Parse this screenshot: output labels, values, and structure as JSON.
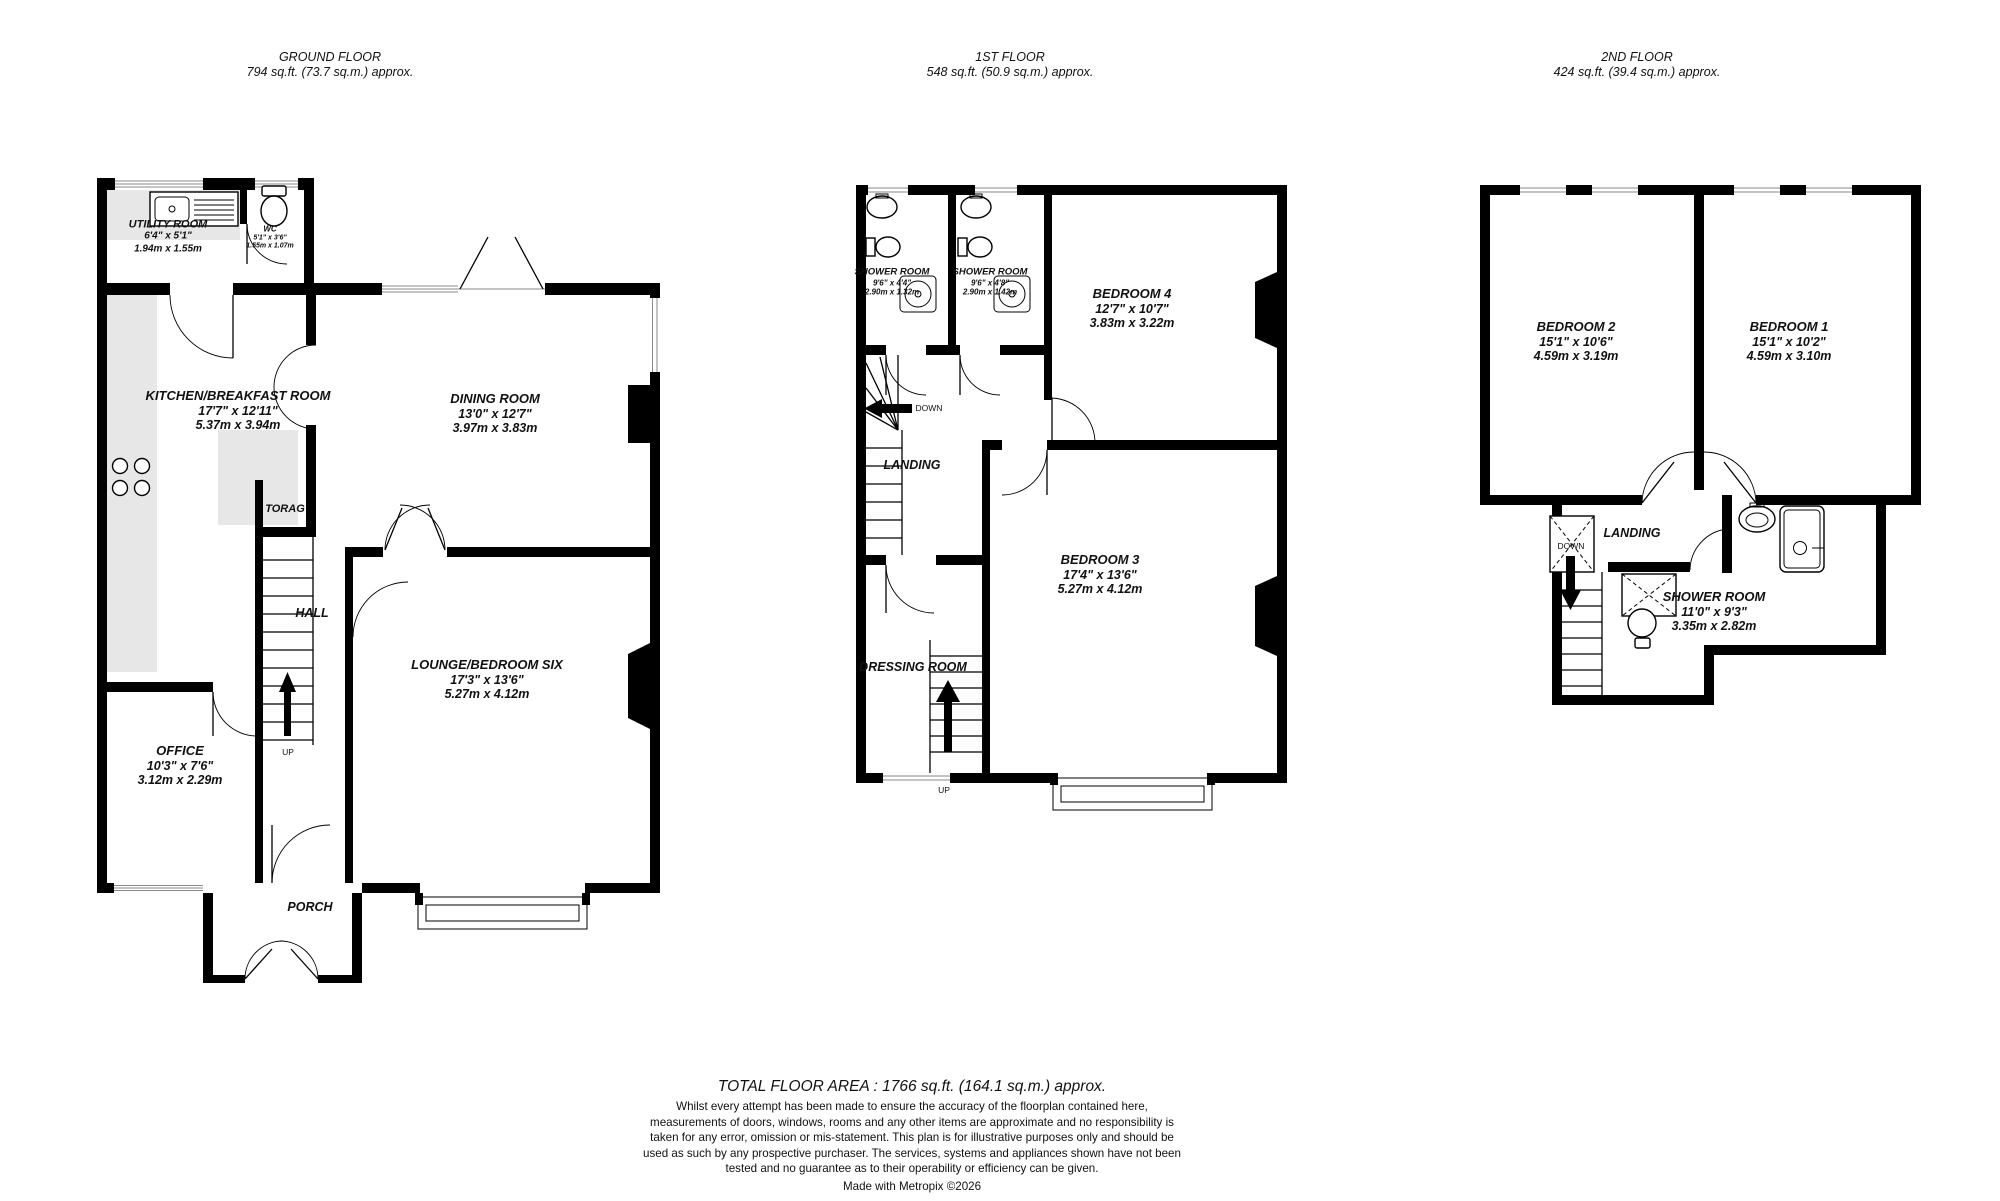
{
  "floors": {
    "ground": {
      "title": "GROUND FLOOR",
      "area": "794 sq.ft. (73.7 sq.m.) approx.",
      "rooms": {
        "utility": {
          "name": "UTILITY ROOM",
          "ft": "6'4\" x 5'1\"",
          "m": "1.94m x 1.55m"
        },
        "wc": {
          "name": "WC",
          "ft": "5'1\" x 3'6\"",
          "m": "1.55m x 1.07m"
        },
        "kitchen": {
          "name": "KITCHEN/BREAKFAST ROOM",
          "ft": "17'7\" x 12'11\"",
          "m": "5.37m x 3.94m"
        },
        "dining": {
          "name": "DINING ROOM",
          "ft": "13'0\" x 12'7\"",
          "m": "3.97m x 3.83m"
        },
        "storage": {
          "name": "TORAG"
        },
        "hall": {
          "name": "HALL"
        },
        "office": {
          "name": "OFFICE",
          "ft": "10'3\" x 7'6\"",
          "m": "3.12m x 2.29m"
        },
        "lounge": {
          "name": "LOUNGE/BEDROOM SIX",
          "ft": "17'3\" x 13'6\"",
          "m": "5.27m x 4.12m"
        },
        "porch": {
          "name": "PORCH"
        }
      },
      "stairs_up_label": "UP"
    },
    "first": {
      "title": "1ST FLOOR",
      "area": "548 sq.ft. (50.9 sq.m.) approx.",
      "rooms": {
        "shower1": {
          "name": "SHOWER ROOM",
          "ft": "9'6\" x 4'4\"",
          "m": "2.90m x 1.32m"
        },
        "shower2": {
          "name": "SHOWER ROOM",
          "ft": "9'6\" x 4'8\"",
          "m": "2.90m x 1.42m"
        },
        "bedroom4": {
          "name": "BEDROOM 4",
          "ft": "12'7\" x 10'7\"",
          "m": "3.83m x 3.22m"
        },
        "landing": {
          "name": "LANDING"
        },
        "bedroom3": {
          "name": "BEDROOM 3",
          "ft": "17'4\" x 13'6\"",
          "m": "5.27m x 4.12m"
        },
        "dressing": {
          "name": "DRESSING ROOM"
        }
      },
      "stairs_down_label": "DOWN",
      "stairs_up_label": "UP"
    },
    "second": {
      "title": "2ND FLOOR",
      "area": "424 sq.ft. (39.4 sq.m.) approx.",
      "rooms": {
        "bedroom2": {
          "name": "BEDROOM 2",
          "ft": "15'1\" x 10'6\"",
          "m": "4.59m x 3.19m"
        },
        "bedroom1": {
          "name": "BEDROOM 1",
          "ft": "15'1\" x 10'2\"",
          "m": "4.59m x 3.10m"
        },
        "landing": {
          "name": "LANDING"
        },
        "shower": {
          "name": "SHOWER ROOM",
          "ft": "11'0\" x 9'3\"",
          "m": "3.35m x 2.82m"
        }
      },
      "stairs_down_label": "DOWN"
    }
  },
  "footer": {
    "total": "TOTAL FLOOR AREA : 1766 sq.ft. (164.1 sq.m.) approx.",
    "disclaimer": "Whilst every attempt has been made to ensure the accuracy of the floorplan contained here, measurements of doors, windows, rooms and any other items are approximate and no responsibility is taken for any error, omission or mis-statement. This plan is for illustrative purposes only and should be used as such by any prospective purchaser. The services, systems and appliances shown have not been tested and no guarantee as to their operability or efficiency can be given.",
    "credit": "Made with Metropix ©2026"
  },
  "colors": {
    "wall": "#000000",
    "counter": "#e7e7e7",
    "text": "#111111"
  }
}
